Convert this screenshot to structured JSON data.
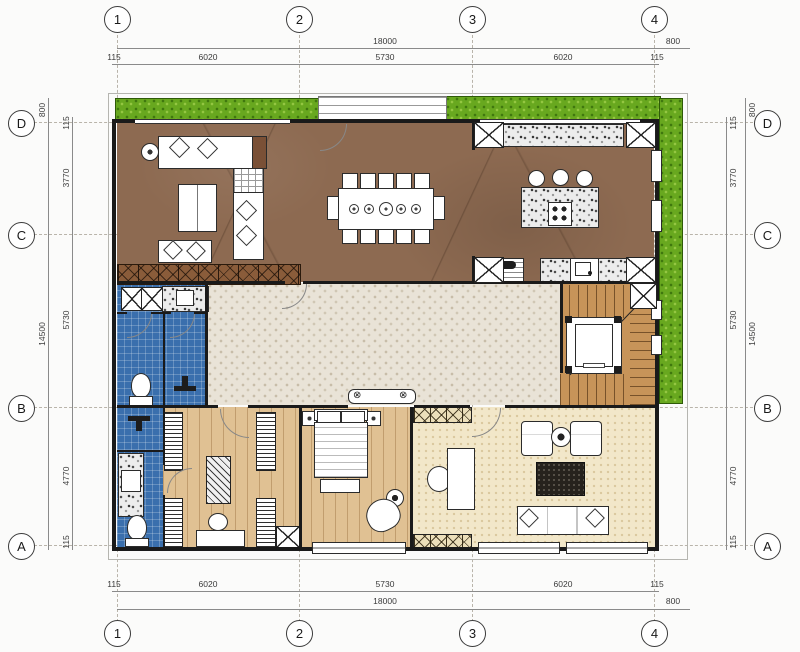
{
  "drawing": {
    "grid": {
      "cols": [
        "1",
        "2",
        "3",
        "4"
      ],
      "rows": [
        "D",
        "C",
        "B",
        "A"
      ]
    },
    "dims": {
      "h_total": "18000",
      "v_total": "14500",
      "overhang": "800",
      "h_segments": [
        "115",
        "6020",
        "5730",
        "6020",
        "115"
      ],
      "v_segments": [
        "115",
        "3770",
        "5730",
        "4770",
        "115"
      ]
    },
    "icons": {
      "crossed_circle": "⊗"
    },
    "colors": {
      "marble_floor": "#8d6a51",
      "grass": "#68a81f",
      "bath_tile": "#3a6fad",
      "corridor_carpet": "#e9e3d7",
      "wood_floor": "#e0c193",
      "stair_wood": "#c79459",
      "family_carpet": "#f2e7c9",
      "rug": "#26221d",
      "wall_line": "#1a1a1a"
    }
  }
}
